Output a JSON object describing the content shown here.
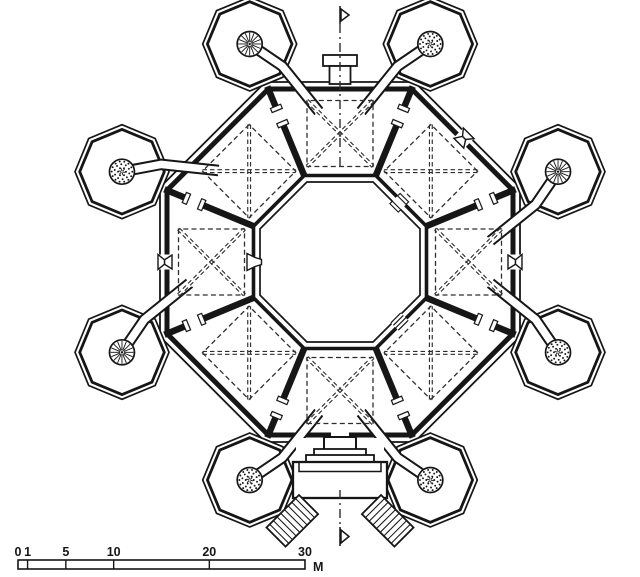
{
  "drawing": {
    "kind": "architectural-floor-plan",
    "subject": "octagonal castle plan with eight octagonal corner towers, eight cross-vaulted trapezoidal rooms, central octagonal courtyard, twin entrance stairs"
  },
  "colors": {
    "background": "#ffffff",
    "ink": "#161616",
    "dash": "#2e2e2e"
  },
  "plan": {
    "center": [
      340,
      262
    ],
    "outer_apothem": 180,
    "inner_apothem": 173,
    "courtyard_outer_apothem": 86.5,
    "courtyard_inner_apothem": 80,
    "tower_center_radius": 236,
    "tower_outer_circumradius": 47,
    "tower_inner_circumradius": 42.3,
    "stair_circle_radius": 12.5,
    "vault_center_radius": 128.5,
    "vault_half_size": 33,
    "party_wall_r0": 90,
    "party_wall_r1": 190,
    "party_door_r": 158,
    "corridor_entry_r": 152,
    "towers": [
      {
        "id": "nnw",
        "angle": -112.5,
        "stair": "spoke",
        "room_angle": -90
      },
      {
        "id": "nne",
        "angle": -67.5,
        "stair": "stippled",
        "room_angle": -90
      },
      {
        "id": "ene",
        "angle": -22.5,
        "stair": "spoke",
        "room_angle": 0
      },
      {
        "id": "ese",
        "angle": 22.5,
        "stair": "stippled",
        "room_angle": 0
      },
      {
        "id": "sse",
        "angle": 67.5,
        "stair": "stippled",
        "room_angle": 90
      },
      {
        "id": "ssw",
        "angle": 112.5,
        "stair": "stippled",
        "room_angle": 90
      },
      {
        "id": "wsw",
        "angle": 157.5,
        "stair": "spoke",
        "room_angle": 180
      },
      {
        "id": "wnw",
        "angle": -157.5,
        "stair": "stippled",
        "room_angle": -135
      }
    ],
    "rooms": [
      {
        "id": "n",
        "angle": -90,
        "window": false
      },
      {
        "id": "ne",
        "angle": -45,
        "window": true
      },
      {
        "id": "e",
        "angle": 0,
        "window": true
      },
      {
        "id": "se",
        "angle": 45,
        "window": false
      },
      {
        "id": "s",
        "angle": 90,
        "window": false
      },
      {
        "id": "sw",
        "angle": 135,
        "window": false
      },
      {
        "id": "w",
        "angle": 180,
        "window": true
      },
      {
        "id": "nw",
        "angle": -135,
        "window": false
      }
    ],
    "courtyard_doors": [
      {
        "side": "w",
        "angle": 180,
        "type": "flared"
      },
      {
        "side": "ne",
        "angle": -45,
        "type": "plain"
      },
      {
        "side": "se",
        "angle": 45,
        "type": "stepped"
      }
    ],
    "party_wall_angles": [
      -112.5,
      -67.5,
      -22.5,
      22.5,
      67.5,
      112.5,
      157.5,
      -157.5
    ],
    "north_projection": {
      "cap": [
        323,
        55,
        34,
        11
      ],
      "box": [
        329.5,
        66,
        21,
        18
      ]
    },
    "entrance": {
      "door_gap": [
        331,
        426,
        18,
        20
      ],
      "reveal": [
        324,
        437,
        32,
        13
      ],
      "plinths": [
        [
          314,
          449,
          52,
          7
        ],
        [
          306,
          455,
          68,
          8
        ]
      ],
      "landing": [
        293,
        462,
        94,
        36
      ],
      "stair_length": 46,
      "stair_width": 27,
      "left_origin": [
        299,
        495
      ],
      "right_origin": [
        381,
        495
      ]
    },
    "section_marker": {
      "x": 340,
      "top_flag_y": 6,
      "top_line": [
        24,
        170
      ],
      "bottom_line": [
        490,
        526
      ],
      "bottom_flag_y": 527
    }
  },
  "scale_bar": {
    "x": 18,
    "y": 560,
    "height": 9,
    "px_per_m": 9.5667,
    "ticks": [
      {
        "label": "0",
        "m": 0
      },
      {
        "label": "1",
        "m": 1
      },
      {
        "label": "5",
        "m": 5
      },
      {
        "label": "10",
        "m": 10
      },
      {
        "label": "20",
        "m": 20
      },
      {
        "label": "30",
        "m": 30
      }
    ],
    "divider_marks_m": [
      1,
      5,
      10,
      20
    ],
    "unit": "M"
  }
}
